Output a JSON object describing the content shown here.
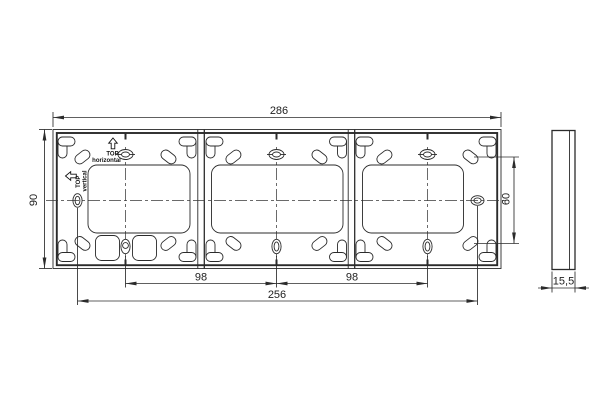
{
  "colors": {
    "line": "#2b2b2b",
    "text": "#222222",
    "background": "#ffffff"
  },
  "dimensions": {
    "overall_width": "286",
    "overall_height": "90",
    "pitch_left": "98",
    "pitch_right": "98",
    "fixing_span": "256",
    "vertical_span": "60",
    "depth": "15,5"
  },
  "front_view": {
    "orientation": {
      "horizontal": {
        "line1": "TOP",
        "line2": "horizontal",
        "icon": "arrow-up-icon"
      },
      "vertical": {
        "line1": "TOP",
        "line2": "vertical",
        "icon": "arrow-left-icon"
      }
    }
  }
}
